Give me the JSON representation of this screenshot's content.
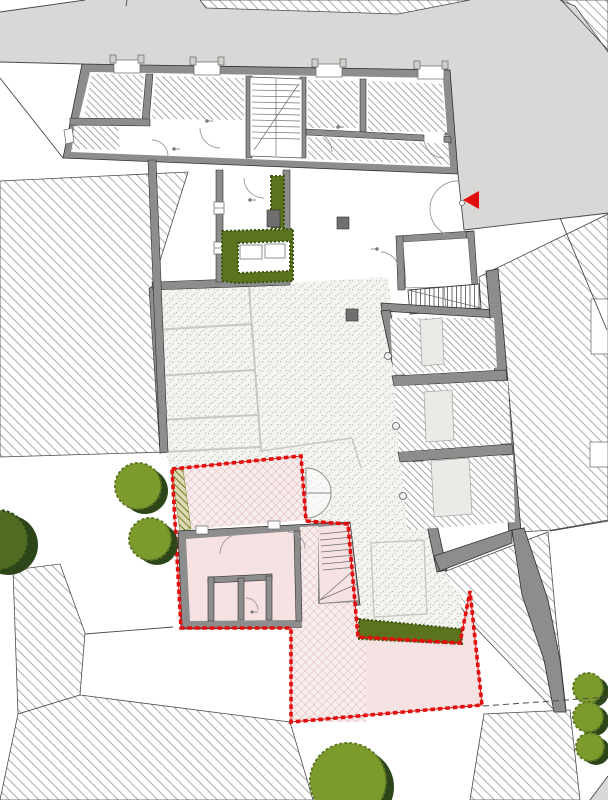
{
  "colors": {
    "street": "#d8d8d6",
    "wall": "#8d8d8d",
    "wall-edge": "#2f2f2f",
    "hatch": "#a2a2a2",
    "room-hatch": "#8f8f8f",
    "stipple-bg": "#f4f4f0",
    "stipple-dot": "#bfbfb7",
    "parking-line": "#c8c8c3",
    "pink": "#f6e2e2",
    "pink-cross-bg": "#f8ecec",
    "pink-cross-line": "#d6a8a8",
    "boundary-red": "#e30d0d",
    "arrow-red": "#e30d0d",
    "tree": "#7d9b2d",
    "tree-shadow": "#2c461a",
    "tree-edge": "#5f7a22",
    "hedge": "#5b731c",
    "hedge-edge": "#3d5313",
    "olive-bg": "#ded8b4",
    "olive-line": "#6f7e22",
    "line": "#4a4a4a",
    "light-square": "#eaeae7"
  },
  "markers": {
    "entrance_arrow": {
      "icon": "triangle-left-icon",
      "color": "#e30d0d"
    }
  },
  "counts": {
    "trees": 4,
    "bushes": 3,
    "parking_stalls": 4,
    "garage_rooms": 3
  }
}
